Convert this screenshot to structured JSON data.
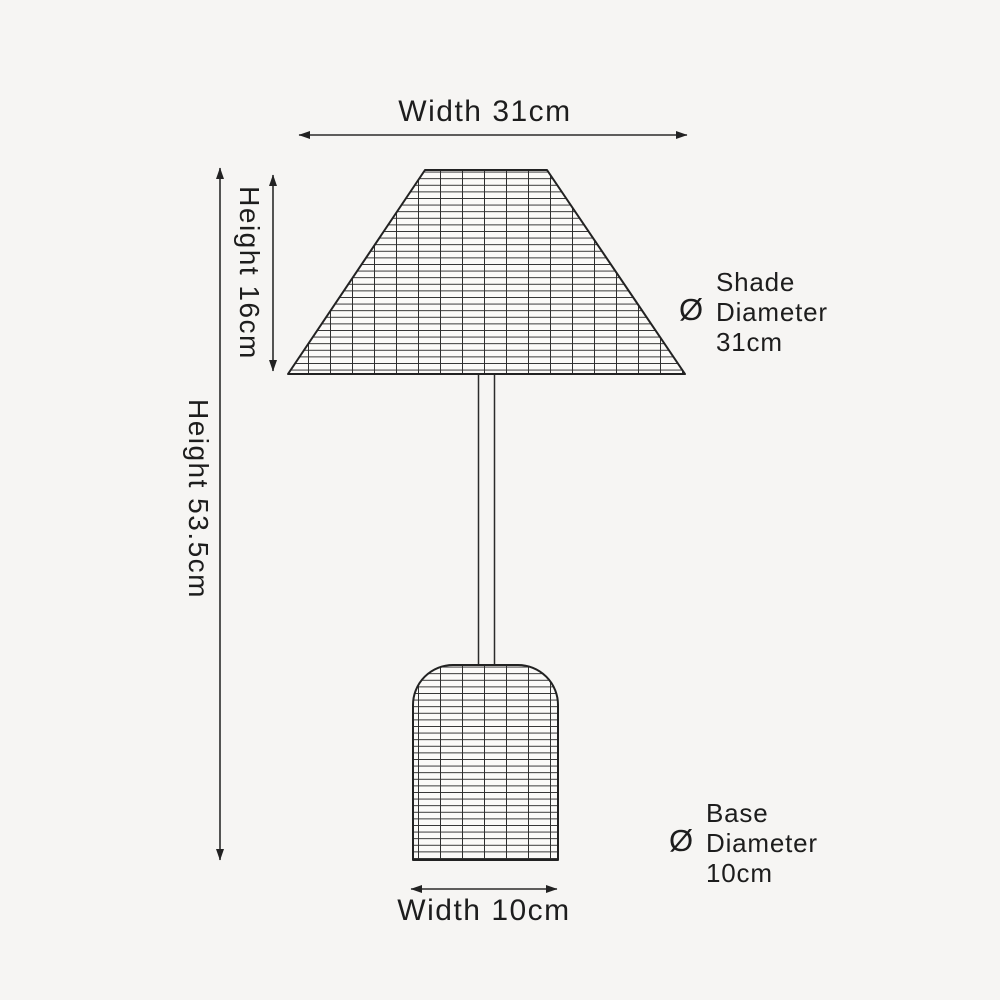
{
  "labels": {
    "shade_width": "Width 31cm",
    "shade_height": "Height 16cm",
    "overall_height": "Height 53.5cm",
    "base_width": "Width 10cm"
  },
  "shade_diameter": {
    "line1": "Shade",
    "symbol": "Ø",
    "line2": "Diameter",
    "line3": "31cm"
  },
  "base_diameter": {
    "line1": "Base",
    "symbol": "Ø",
    "line2": "Diameter",
    "line3": "10cm"
  },
  "measurements": {
    "shade_width_cm": 31,
    "shade_height_cm": 16,
    "overall_height_cm": 53.5,
    "base_width_cm": 10,
    "shade_diameter_cm": 31,
    "base_diameter_cm": 10
  },
  "colors": {
    "background": "#f6f5f3",
    "outline": "#222222",
    "grid_line": "#2f2f2f",
    "dimension_line": "#2b2b2b",
    "text": "#1d1d1d",
    "weave_fill": "#fbfaf8"
  }
}
